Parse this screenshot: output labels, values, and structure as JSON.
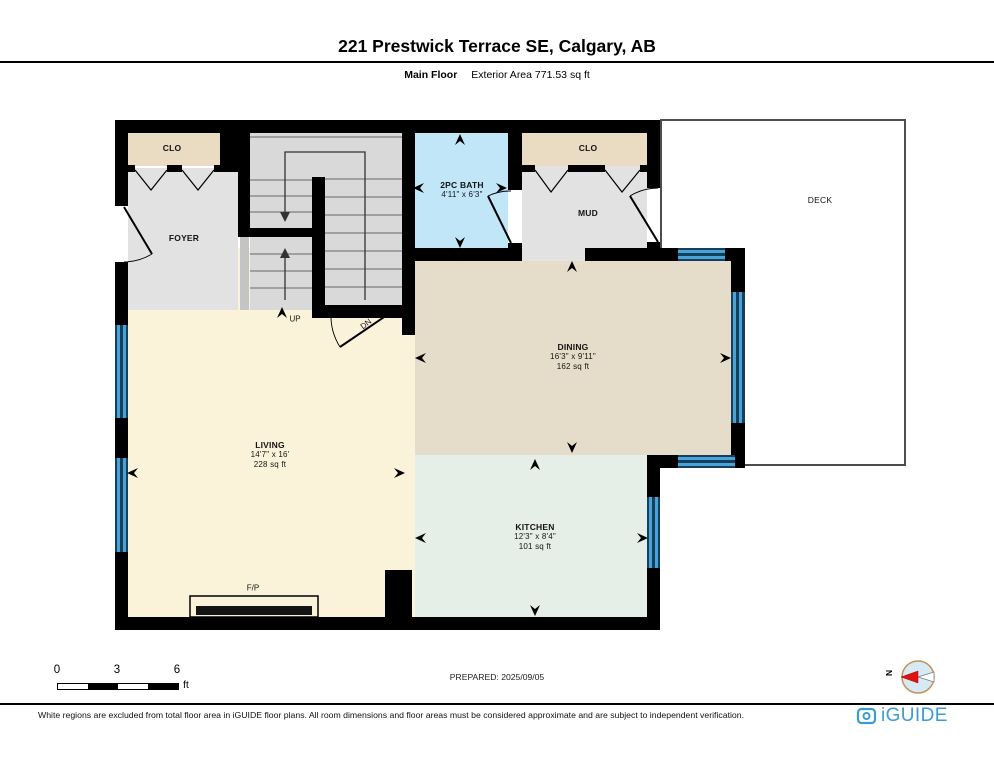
{
  "header": {
    "title": "221 Prestwick Terrace SE, Calgary, AB",
    "floor_label": "Main Floor",
    "area_label": "Exterior Area 771.53 sq ft"
  },
  "plan": {
    "rooms": {
      "living": {
        "name": "LIVING",
        "dims": "14'7\" x 16'",
        "area": "228 sq ft"
      },
      "dining": {
        "name": "DINING",
        "dims": "16'3\" x 9'11\"",
        "area": "162 sq ft"
      },
      "kitchen": {
        "name": "KITCHEN",
        "dims": "12'3\" x 8'4\"",
        "area": "101 sq ft"
      },
      "bath": {
        "name": "2PC BATH",
        "dims": "4'11\" x 6'3\""
      },
      "mud": {
        "name": "MUD"
      },
      "foyer": {
        "name": "FOYER"
      },
      "closet_front": {
        "name": "CLO"
      },
      "closet_mud": {
        "name": "CLO"
      },
      "deck": {
        "name": "DECK"
      },
      "fireplace": {
        "name": "F/P"
      },
      "stair_up": {
        "name": "UP"
      },
      "stair_down": {
        "name": "DN"
      }
    }
  },
  "scale_bar": {
    "tick0": "0",
    "tick3": "3",
    "tick6": "6",
    "unit": "ft"
  },
  "prepared_label": "PREPARED: 2025/09/05",
  "compass": {
    "north_label": "N"
  },
  "footer": {
    "disclaimer": "White regions are excluded from total floor area in iGUIDE floor plans. All room dimensions and floor areas must be considered approximate and are subject to independent verification.",
    "brand": "iGUIDE"
  },
  "colors": {
    "wall": "#000000",
    "living": "#faf3da",
    "dining": "#e5dcc9",
    "kitchen": "#e5eee7",
    "bath": "#c1e6f8",
    "closet": "#e9dcc3",
    "gray_room": "#e2e2e2",
    "stairs": "#d9d9d9",
    "window_blue": "#4aa2d8",
    "brand_blue": "#3d9bd1",
    "compass_red": "#e11212"
  }
}
